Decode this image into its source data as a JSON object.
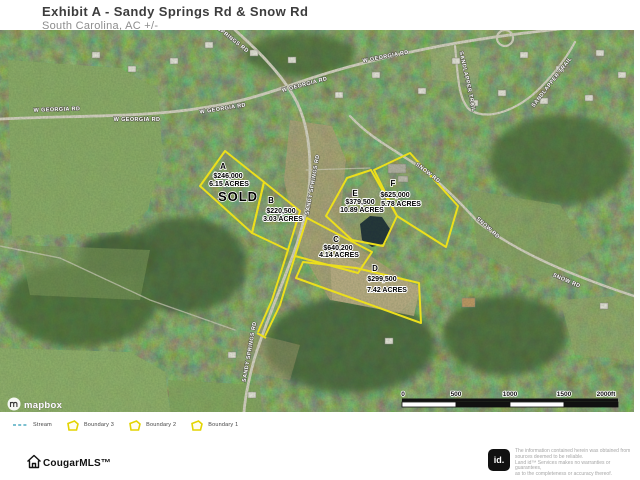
{
  "header": {
    "title": "Exhibit A - Sandy Springs Rd & Snow Rd",
    "subtitle": "South Carolina,  AC +/-"
  },
  "map": {
    "roads": {
      "w_georgia": "W GEORGIA RD",
      "springs_partial": "SPRINGS RD",
      "sandy_springs": "SANDY SPRINGS RD",
      "snow": "SNOW RD",
      "sandlapper": "SANDLAPPER TRAIL"
    },
    "parcels": [
      {
        "id": "A",
        "price": "$246,000",
        "acres": "6.15 ACRES",
        "status": "SOLD"
      },
      {
        "id": "B",
        "price": "$220,500",
        "acres": "3.03 ACRES"
      },
      {
        "id": "C",
        "price": "$640,200",
        "acres": "4.14 ACRES"
      },
      {
        "id": "D",
        "price": "$299,500",
        "acres": "7.42 ACRES"
      },
      {
        "id": "E",
        "price": "$379,500",
        "acres": "10.89 ACRES"
      },
      {
        "id": "F",
        "price": "$625,000",
        "acres": "5.78 ACRES"
      }
    ],
    "boundary_color": "#ecdf1c",
    "scale": {
      "ticks": [
        "0",
        "500",
        "1000",
        "1500",
        "2000ft"
      ]
    },
    "attribution": "mapbox"
  },
  "legend": {
    "items": [
      {
        "label": "Stream"
      },
      {
        "label": "Boundary 3"
      },
      {
        "label": "Boundary 2"
      },
      {
        "label": "Boundary 1"
      }
    ]
  },
  "footer": {
    "brand": "CougarMLS™",
    "land_id": "id.",
    "disclaimer": [
      "The information contained herein was obtained from",
      "sources deemed to be reliable.",
      "Land id™ Services makes no warranties or guarantees,",
      "as to the completeness or accuracy thereof."
    ]
  }
}
